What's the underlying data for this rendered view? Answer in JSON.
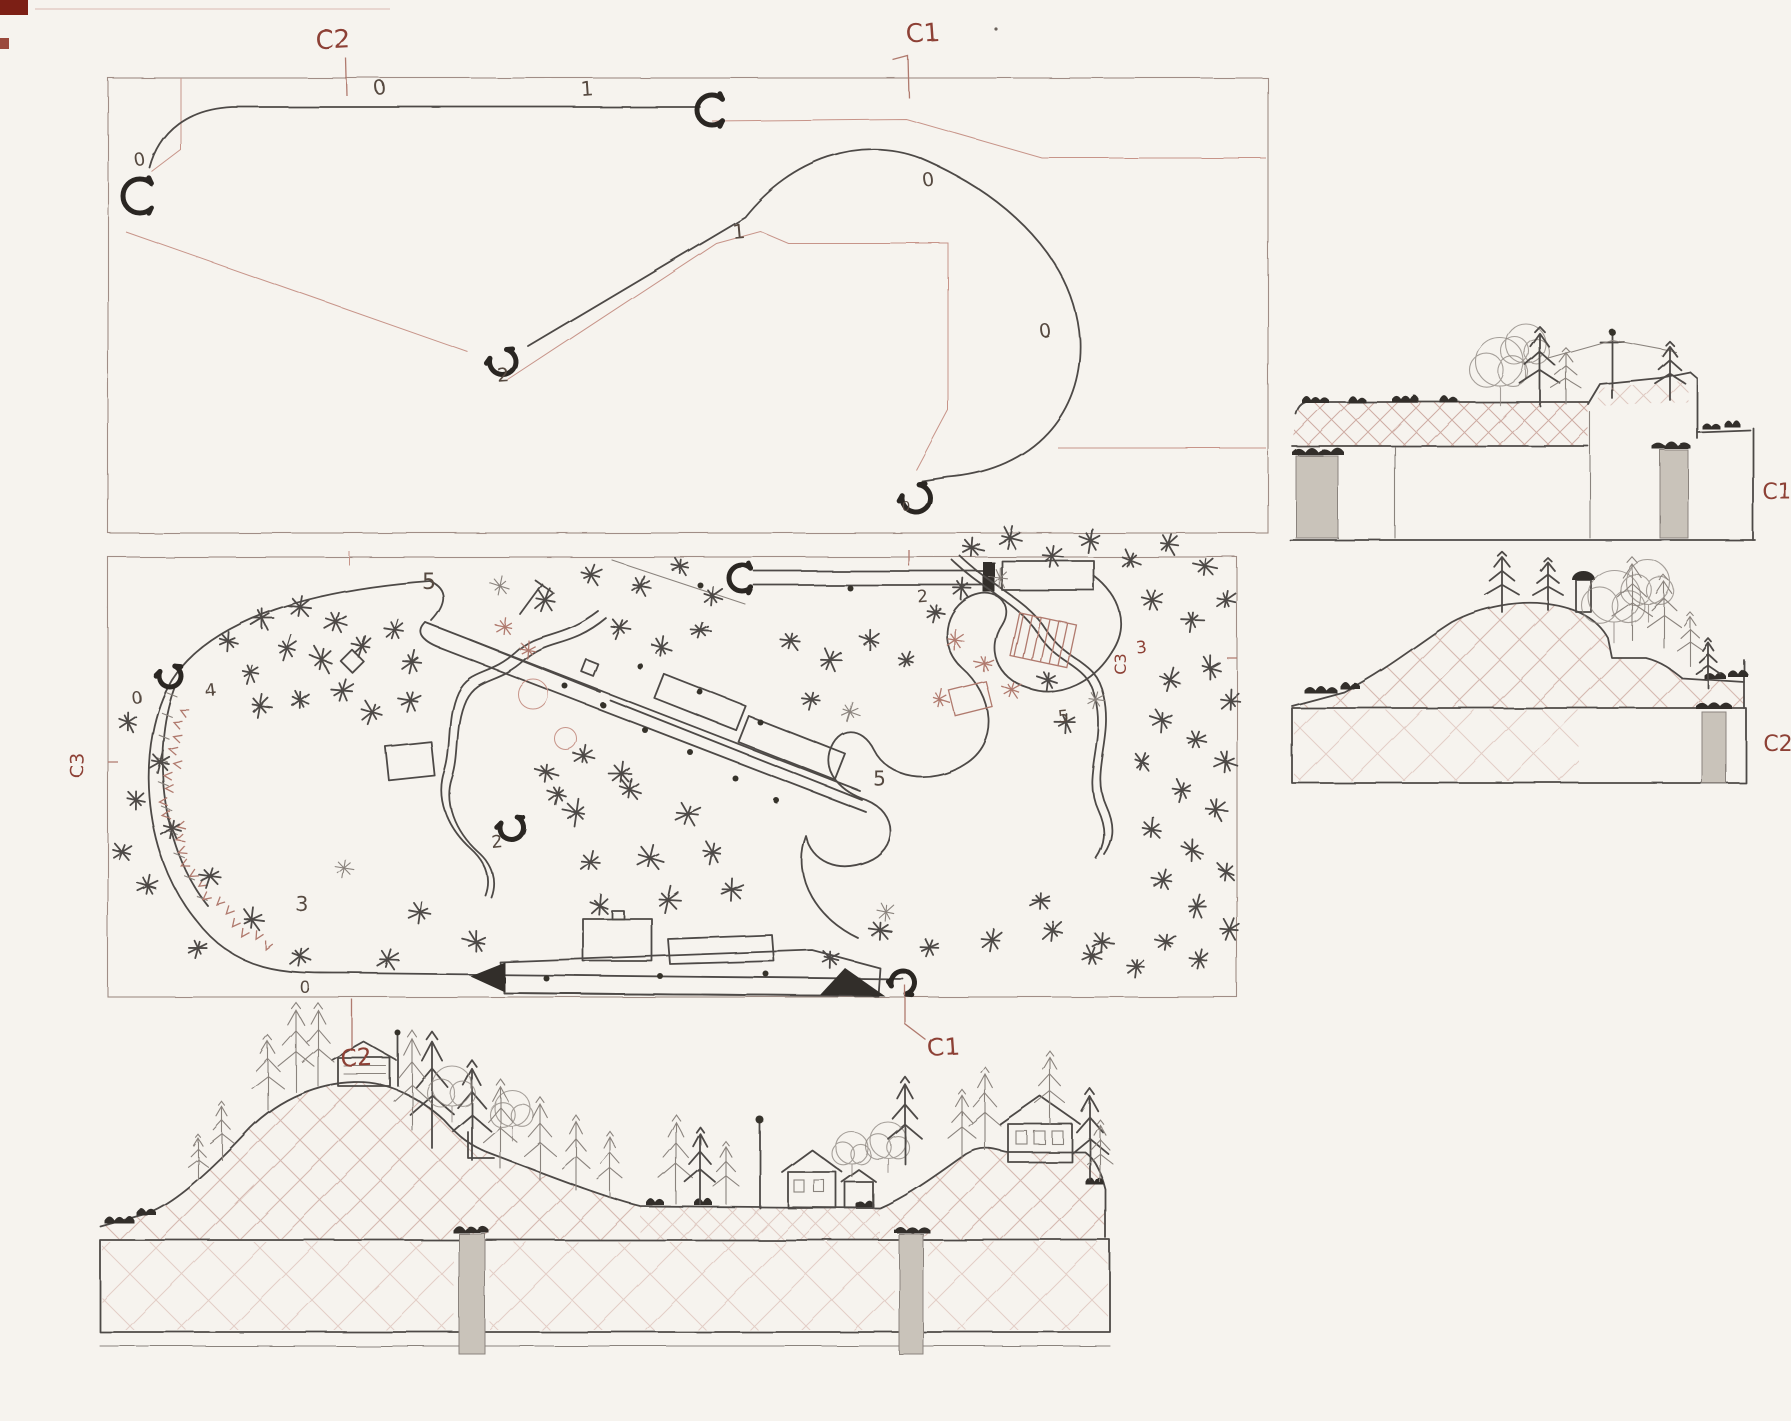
{
  "colors": {
    "paper": "#f6f3ee",
    "pencil": "#4e4a46",
    "pencil_bold": "#2b2724",
    "pencil_light": "#8a837d",
    "pink_line": "#c79489",
    "red_label": "#8d4136",
    "grey_fill": "#c9c3ba",
    "corner_mark": "#7c1f15"
  },
  "labels": {
    "schematic": [
      {
        "id": "c2-top",
        "text": "C2",
        "x": 333,
        "y": 48,
        "s": 26,
        "c": "red",
        "r": -3
      },
      {
        "id": "c1-top",
        "text": "C1",
        "x": 924,
        "y": 42,
        "s": 25,
        "c": "red",
        "r": -4
      },
      {
        "id": "sch-0-straight",
        "text": "0",
        "x": 381,
        "y": 95,
        "s": 20,
        "c": "dark",
        "r": -6
      },
      {
        "id": "sch-1-straight",
        "text": "1",
        "x": 588,
        "y": 96,
        "s": 20,
        "c": "dark",
        "r": -4
      },
      {
        "id": "sch-0-lefthook",
        "text": "0",
        "x": 141,
        "y": 166,
        "s": 18,
        "c": "dark",
        "r": -10
      },
      {
        "id": "sch-1-diagonal",
        "text": "1",
        "x": 739,
        "y": 238,
        "s": 20,
        "c": "dark",
        "r": -5
      },
      {
        "id": "sch-2-hook",
        "text": "2",
        "x": 504,
        "y": 382,
        "s": 19,
        "c": "dark",
        "r": -4
      },
      {
        "id": "sch-0-curve-top",
        "text": "0",
        "x": 929,
        "y": 186,
        "s": 19,
        "c": "dark",
        "r": -8
      },
      {
        "id": "sch-0-curve-right",
        "text": "0",
        "x": 1046,
        "y": 337,
        "s": 19,
        "c": "dark",
        "r": -8
      },
      {
        "id": "sch-0-bottom-hook",
        "text": "0",
        "x": 906,
        "y": 511,
        "s": 13,
        "c": "dark",
        "r": 0
      }
    ],
    "plan": [
      {
        "id": "plan-5-top",
        "text": "5",
        "x": 429,
        "y": 589,
        "s": 22,
        "c": "dark",
        "r": 0
      },
      {
        "id": "plan-4-left",
        "text": "4",
        "x": 211,
        "y": 696,
        "s": 18,
        "c": "dark",
        "r": -8
      },
      {
        "id": "plan-0-portal-left",
        "text": "0",
        "x": 137,
        "y": 703,
        "s": 17,
        "c": "dark",
        "r": -6
      },
      {
        "id": "plan-3-cliff",
        "text": "3",
        "x": 302,
        "y": 911,
        "s": 20,
        "c": "dark",
        "r": 0
      },
      {
        "id": "plan-0-bottom-left",
        "text": "0",
        "x": 305,
        "y": 993,
        "s": 17,
        "c": "dark",
        "r": 0
      },
      {
        "id": "plan-2-portal",
        "text": "2",
        "x": 498,
        "y": 848,
        "s": 18,
        "c": "dark",
        "r": -6
      },
      {
        "id": "plan-2-siding",
        "text": "2",
        "x": 923,
        "y": 602,
        "s": 17,
        "c": "dark",
        "r": -5
      },
      {
        "id": "plan-5-serpentine",
        "text": "5",
        "x": 880,
        "y": 786,
        "s": 20,
        "c": "dark",
        "r": 0
      },
      {
        "id": "plan-5-right",
        "text": "5",
        "x": 1064,
        "y": 722,
        "s": 17,
        "c": "dark",
        "r": -6
      },
      {
        "id": "plan-3-right",
        "text": "3",
        "x": 1142,
        "y": 653,
        "s": 17,
        "c": "red",
        "r": -6
      },
      {
        "id": "c3-left",
        "text": "C3",
        "x": 83,
        "y": 765,
        "s": 19,
        "c": "red",
        "r": -90
      },
      {
        "id": "c3-right",
        "text": "C3",
        "x": 1126,
        "y": 664,
        "s": 16,
        "c": "red",
        "r": -90
      }
    ],
    "sections": [
      {
        "id": "c1-section",
        "text": "C1",
        "x": 1777,
        "y": 499,
        "s": 22,
        "c": "red",
        "r": 0
      },
      {
        "id": "c2-section",
        "text": "C2",
        "x": 1778,
        "y": 751,
        "s": 22,
        "c": "red",
        "r": 0
      }
    ],
    "elevation": [
      {
        "id": "c2-elevation",
        "text": "C2",
        "x": 357,
        "y": 1066,
        "s": 24,
        "c": "red",
        "r": -3
      },
      {
        "id": "c1-elevation",
        "text": "C1",
        "x": 944,
        "y": 1055,
        "s": 24,
        "c": "red",
        "r": -4
      }
    ]
  },
  "trees": {
    "plan": [
      [
        262,
        618,
        11,
        0
      ],
      [
        300,
        607,
        12,
        0
      ],
      [
        336,
        622,
        10,
        0
      ],
      [
        287,
        648,
        11,
        0
      ],
      [
        322,
        660,
        12,
        0
      ],
      [
        362,
        646,
        10,
        0
      ],
      [
        250,
        672,
        10,
        0
      ],
      [
        395,
        630,
        11,
        0
      ],
      [
        412,
        662,
        10,
        0
      ],
      [
        342,
        690,
        11,
        0
      ],
      [
        300,
        700,
        10,
        0
      ],
      [
        372,
        712,
        11,
        0
      ],
      [
        260,
        706,
        10,
        0
      ],
      [
        410,
        700,
        10,
        0
      ],
      [
        228,
        641,
        9,
        0
      ],
      [
        128,
        722,
        9,
        0
      ],
      [
        160,
        762,
        10,
        0
      ],
      [
        136,
        800,
        9,
        0
      ],
      [
        172,
        828,
        10,
        0
      ],
      [
        122,
        852,
        9,
        0
      ],
      [
        148,
        886,
        9,
        0
      ],
      [
        210,
        876,
        10,
        0
      ],
      [
        252,
        920,
        10,
        0
      ],
      [
        198,
        948,
        9,
        0
      ],
      [
        300,
        956,
        10,
        0
      ],
      [
        420,
        912,
        10,
        0
      ],
      [
        476,
        942,
        11,
        0
      ],
      [
        388,
        960,
        10,
        0
      ],
      [
        344,
        868,
        9,
        1
      ],
      [
        576,
        812,
        11,
        0
      ],
      [
        630,
        790,
        11,
        0
      ],
      [
        688,
        814,
        11,
        0
      ],
      [
        590,
        862,
        10,
        0
      ],
      [
        650,
        858,
        11,
        0
      ],
      [
        712,
        852,
        10,
        0
      ],
      [
        668,
        900,
        11,
        0
      ],
      [
        600,
        906,
        10,
        0
      ],
      [
        732,
        890,
        10,
        0
      ],
      [
        546,
        772,
        10,
        0
      ],
      [
        584,
        756,
        9,
        0
      ],
      [
        622,
        774,
        10,
        0
      ],
      [
        558,
        794,
        9,
        0
      ],
      [
        500,
        586,
        9,
        1
      ],
      [
        545,
        600,
        10,
        0
      ],
      [
        590,
        574,
        10,
        0
      ],
      [
        640,
        586,
        9,
        0
      ],
      [
        680,
        566,
        9,
        0
      ],
      [
        712,
        596,
        10,
        0
      ],
      [
        620,
        628,
        10,
        0
      ],
      [
        662,
        648,
        10,
        0
      ],
      [
        700,
        630,
        9,
        0
      ],
      [
        505,
        627,
        8,
        2
      ],
      [
        528,
        650,
        8,
        2
      ],
      [
        790,
        640,
        10,
        0
      ],
      [
        830,
        660,
        10,
        0
      ],
      [
        870,
        640,
        9,
        0
      ],
      [
        812,
        700,
        9,
        0
      ],
      [
        850,
        712,
        9,
        1
      ],
      [
        955,
        640,
        9,
        2
      ],
      [
        985,
        664,
        9,
        2
      ],
      [
        1012,
        690,
        9,
        2
      ],
      [
        940,
        700,
        9,
        2
      ],
      [
        972,
        548,
        10,
        0
      ],
      [
        1010,
        538,
        10,
        0
      ],
      [
        1052,
        556,
        10,
        0
      ],
      [
        1090,
        540,
        10,
        0
      ],
      [
        1130,
        560,
        10,
        0
      ],
      [
        1168,
        544,
        10,
        0
      ],
      [
        1205,
        566,
        10,
        0
      ],
      [
        962,
        588,
        9,
        0
      ],
      [
        1000,
        578,
        9,
        1
      ],
      [
        1152,
        600,
        10,
        0
      ],
      [
        1192,
        620,
        10,
        0
      ],
      [
        1226,
        600,
        9,
        0
      ],
      [
        1170,
        680,
        10,
        0
      ],
      [
        1210,
        668,
        10,
        0
      ],
      [
        1230,
        700,
        10,
        0
      ],
      [
        1162,
        720,
        10,
        0
      ],
      [
        1196,
        740,
        10,
        0
      ],
      [
        1226,
        762,
        10,
        0
      ],
      [
        1142,
        762,
        9,
        0
      ],
      [
        1182,
        790,
        10,
        0
      ],
      [
        1216,
        810,
        10,
        0
      ],
      [
        1152,
        830,
        10,
        0
      ],
      [
        1192,
        850,
        10,
        0
      ],
      [
        1226,
        872,
        10,
        0
      ],
      [
        1163,
        880,
        9,
        0
      ],
      [
        1196,
        906,
        10,
        0
      ],
      [
        1230,
        930,
        10,
        0
      ],
      [
        1166,
        942,
        9,
        0
      ],
      [
        1200,
        960,
        10,
        0
      ],
      [
        1136,
        966,
        9,
        0
      ],
      [
        1102,
        942,
        9,
        0
      ],
      [
        1048,
        680,
        9,
        0
      ],
      [
        1066,
        722,
        9,
        0
      ],
      [
        1096,
        700,
        8,
        1
      ],
      [
        880,
        930,
        10,
        0
      ],
      [
        930,
        948,
        10,
        0
      ],
      [
        992,
        940,
        10,
        0
      ],
      [
        1052,
        930,
        10,
        0
      ],
      [
        1092,
        956,
        9,
        0
      ],
      [
        1040,
        900,
        9,
        0
      ],
      [
        886,
        912,
        8,
        1
      ],
      [
        830,
        958,
        8,
        0
      ],
      [
        906,
        660,
        8,
        0
      ],
      [
        935,
        612,
        8,
        0
      ]
    ]
  },
  "dots": {
    "plan": [
      [
        565,
        686
      ],
      [
        603,
        705
      ],
      [
        645,
        730
      ],
      [
        690,
        752
      ],
      [
        735,
        778
      ],
      [
        776,
        800
      ],
      [
        640,
        666
      ],
      [
        700,
        692
      ],
      [
        760,
        722
      ],
      [
        546,
        978
      ],
      [
        660,
        976
      ],
      [
        766,
        974
      ],
      [
        700,
        585
      ],
      [
        850,
        588
      ]
    ]
  }
}
